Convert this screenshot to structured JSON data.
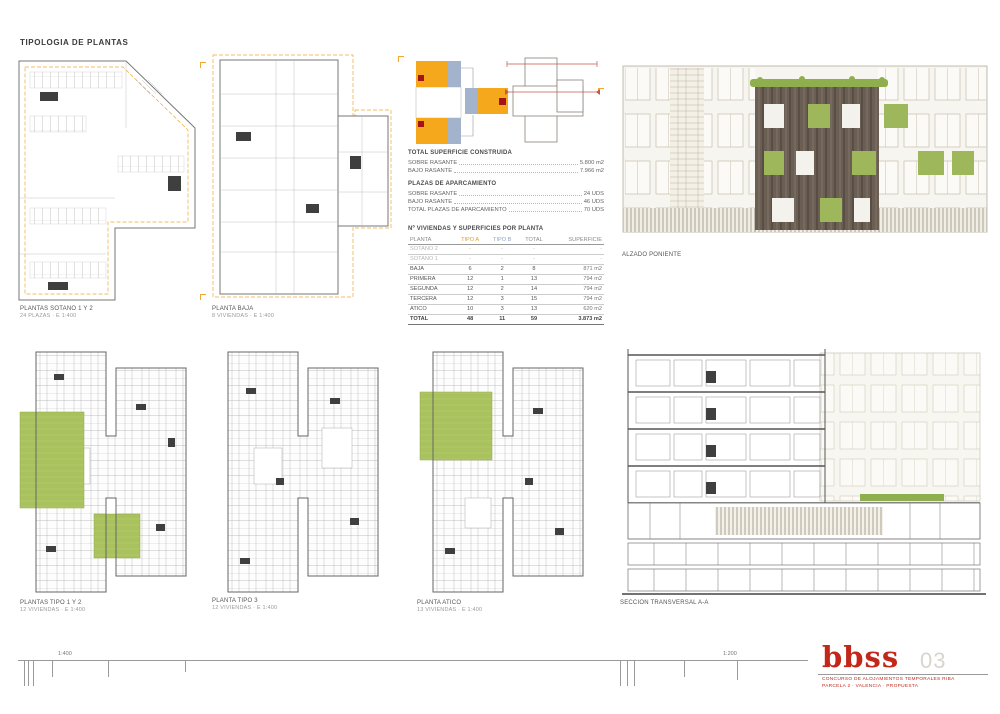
{
  "page": {
    "title": "TIPOLOGIA DE PLANTAS"
  },
  "drawings": {
    "sotano": {
      "label": "PLANTAS SOTANO 1 Y 2",
      "sub": "24 PLAZAS · E 1:400"
    },
    "baja": {
      "label": "PLANTA BAJA",
      "sub": "8 VIVIENDAS · E 1:400"
    },
    "tipo12": {
      "label": "PLANTAS TIPO 1 Y 2",
      "sub": "12 VIVIENDAS · E 1:400"
    },
    "tipo3": {
      "label": "PLANTA TIPO 3",
      "sub": "12 VIVIENDAS · E 1:400"
    },
    "atico": {
      "label": "PLANTA ATICO",
      "sub": "13 VIVIENDAS · E 1:400"
    },
    "alzado": {
      "label": "ALZADO PONIENTE"
    },
    "seccion": {
      "label": "SECCION TRANSVERSAL A-A"
    }
  },
  "summary": {
    "heading": "TOTAL SUPERFICIE CONSTRUIDA",
    "items": [
      {
        "label": "SOBRE RASANTE",
        "value": "5.800 m2"
      },
      {
        "label": "BAJO RASANTE",
        "value": "7.966 m2"
      }
    ],
    "parking_heading": "PLAZAS DE APARCAMIENTO",
    "parking_items": [
      {
        "label": "SOBRE RASANTE",
        "value": "24 UDS"
      },
      {
        "label": "BAJO RASANTE",
        "value": "46 UDS"
      },
      {
        "label": "TOTAL PLAZAS DE APARCAMIENTO",
        "value": "70 UDS"
      }
    ]
  },
  "table": {
    "title": "Nº VIVIENDAS Y SUPERFICIES POR PLANTA",
    "headers": [
      "PLANTA",
      "TIPO A",
      "TIPO B",
      "TOTAL",
      "SUPERFICIE"
    ],
    "rows": [
      [
        "SOTANO 2",
        "-",
        "-",
        "-",
        "-"
      ],
      [
        "SOTANO 1",
        "-",
        "-",
        "-",
        "-"
      ],
      [
        "BAJA",
        "6",
        "2",
        "8",
        "871 m2"
      ],
      [
        "PRIMERA",
        "12",
        "1",
        "13",
        "794 m2"
      ],
      [
        "SEGUNDA",
        "12",
        "2",
        "14",
        "794 m2"
      ],
      [
        "TERCERA",
        "12",
        "3",
        "15",
        "794 m2"
      ],
      [
        "ATICO",
        "10",
        "3",
        "13",
        "620 m2"
      ],
      [
        "TOTAL",
        "48",
        "11",
        "59",
        "3.873 m2"
      ]
    ]
  },
  "footer": {
    "scale_left": "1:400",
    "scale_right": "1:200",
    "logo": "bbss",
    "sheet_number": "03",
    "project_line1": "CONCURSO DE ALOJAMIENTOS TEMPORALES RIBA",
    "project_line2": "PARCELA 2 · VALENCIA · PROPUESTA"
  },
  "colors": {
    "accent_orange": "#f0a830",
    "accent_blue": "#9fb0ce",
    "accent_red": "#a5121a",
    "logo_red": "#c2271a",
    "garden_green": "#a9c25d",
    "facade_brown": "#6b5e53"
  }
}
